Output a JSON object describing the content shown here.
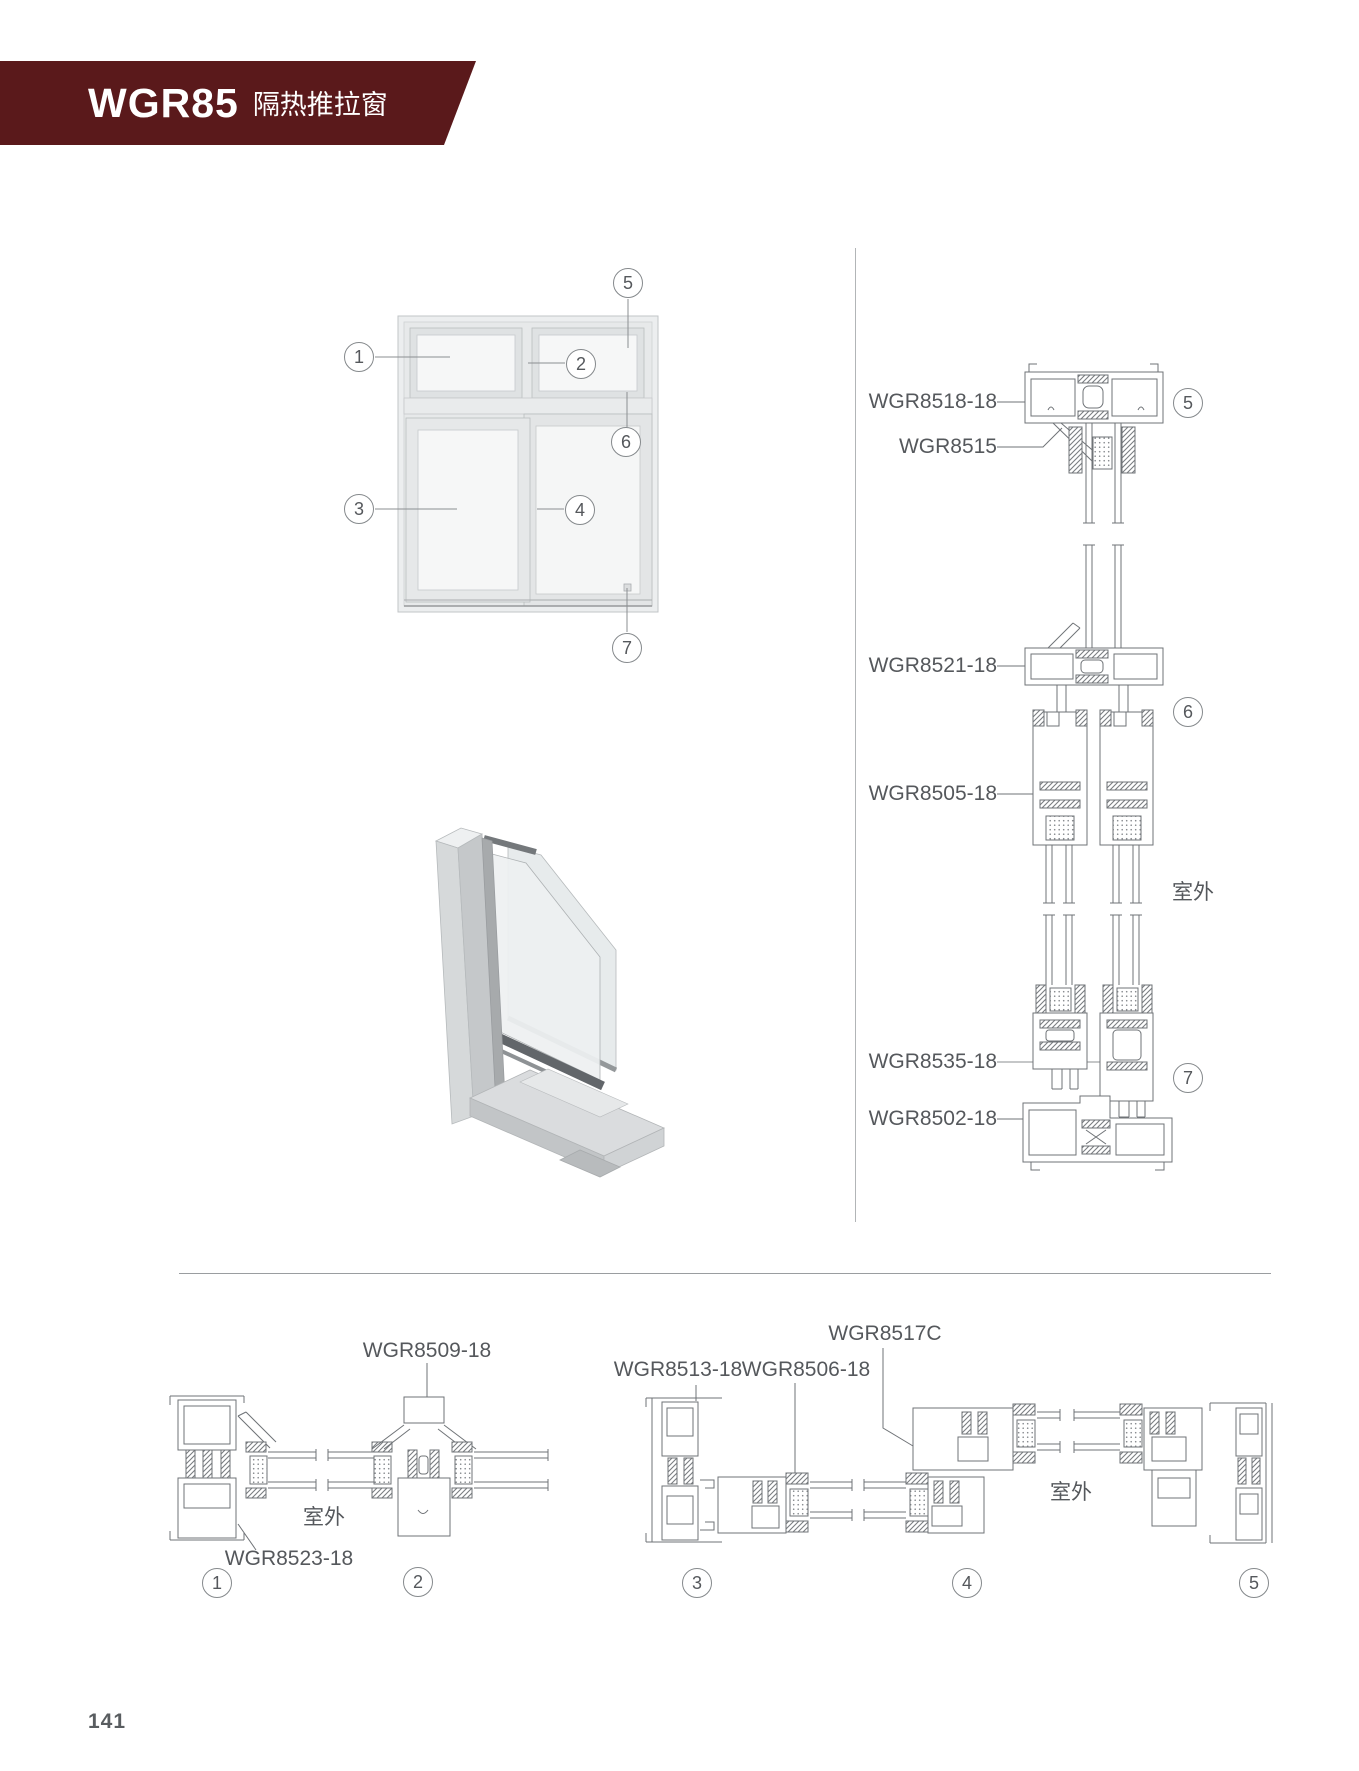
{
  "header": {
    "series": "WGR85",
    "product": "隔热推拉窗",
    "banner_color": "#5a191b"
  },
  "footer": {
    "page_number": "141"
  },
  "elevation": {
    "callouts": [
      {
        "num": "1"
      },
      {
        "num": "2"
      },
      {
        "num": "3"
      },
      {
        "num": "4"
      },
      {
        "num": "5"
      },
      {
        "num": "6"
      },
      {
        "num": "7"
      }
    ]
  },
  "vertical_section": {
    "labels": {
      "top_frame": "WGR8518-18",
      "glazing_bead": "WGR8515",
      "interlock_frame": "WGR8521-18",
      "sash_profile": "WGR8505-18",
      "sash_bottom": "WGR8535-18",
      "bottom_frame": "WGR8502-18"
    },
    "outdoor": "室外",
    "callouts": [
      {
        "num": "5"
      },
      {
        "num": "6"
      },
      {
        "num": "7"
      }
    ]
  },
  "horizontal_section_left": {
    "labels": {
      "mullion": "WGR8509-18",
      "frame_jamb": "WGR8523-18"
    },
    "outdoor": "室外",
    "callouts": [
      {
        "num": "1"
      },
      {
        "num": "2"
      }
    ]
  },
  "horizontal_section_right": {
    "labels": {
      "half_profile": "WGR8517C",
      "jamb": "WGR8513-18",
      "sash": "WGR8506-18"
    },
    "outdoor": "室外",
    "callouts": [
      {
        "num": "3"
      },
      {
        "num": "4"
      },
      {
        "num": "5"
      }
    ]
  }
}
